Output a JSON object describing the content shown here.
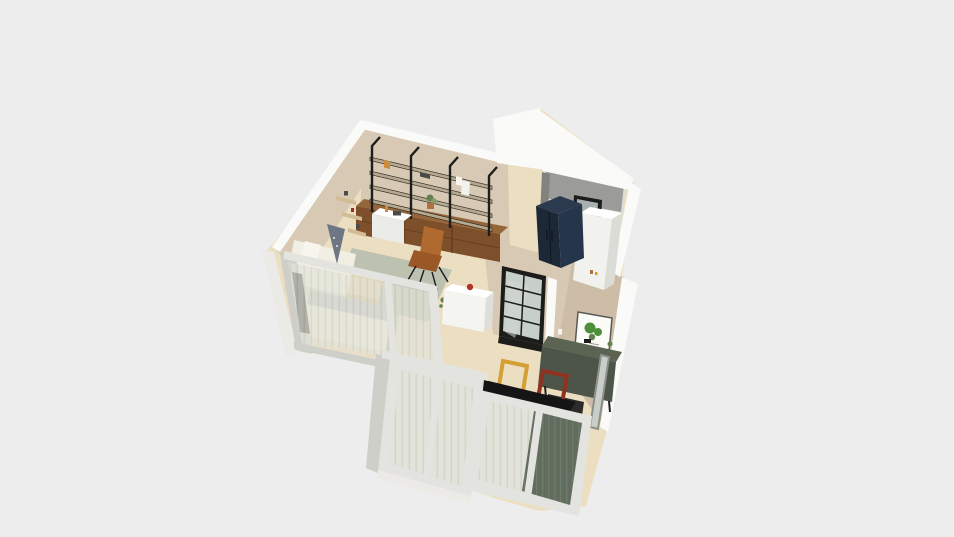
{
  "scene": {
    "type": "3d-floorplan-render",
    "description": "Isometric 3D render of a studio apartment floor plan viewed from above on a plain light grey background",
    "background": "#ededed"
  },
  "palette": {
    "bg": "#ededed",
    "wallWhite": "#fafaf8",
    "wallWhiteShade": "#ebeae6",
    "wallBeige": "#d8c9b4",
    "wallBeigeDark": "#cdbda6",
    "floorCream": "#ecdfc1",
    "floorPale": "#e9dfc9",
    "bathWallGrey": "#9b9b99",
    "bathWallGreyDark": "#82827f",
    "bathFloor": "#dcdcd8",
    "navyCabinet": "#1c2836",
    "navyCabinetSide": "#26364a",
    "navyCabinetTop": "#2c3a50",
    "applianceWhite": "#f1f1ee",
    "applianceShade": "#dcdcd7",
    "windowBlack": "#1c1c1a",
    "windowGlassGrey": "#a8b0b0",
    "glassTint": "#c6cfc8",
    "doorFrameWhite": "#e3e3df",
    "doorFrameShade": "#cfcfca",
    "curtainSheer": "#edebe0",
    "curtainSheerLine": "#d6d2c2",
    "curtainGreen": "#5d685b",
    "curtainGreenLight": "#76816f",
    "shelfBlack": "#1e1e1c",
    "shelfBoardTan": "#b5a88d",
    "cabinetBrown": "#7d4f2a",
    "cabinetBrownTop": "#96663a",
    "cabinetBrownLine": "#5e3a1d",
    "floatShelfTan": "#d2bc96",
    "chairCognac": "#b0692e",
    "chairCognacDark": "#9a5826",
    "rugSage": "#b8beae",
    "bedWhite": "#f1eee3",
    "bedShade": "#ddd7c6",
    "pillowWhite": "#f7f5ed",
    "pillowGrey": "#b9bcbf",
    "tentBlue": "#6e7684",
    "benchTan": "#e4d4ad",
    "benchTanDark": "#d3c094",
    "counterWhite": "#f4f4f1",
    "counterShade": "#dededa",
    "counterTop": "#ffffff",
    "kettleRed": "#b23425",
    "sideboardGreen": "#4c5547",
    "sideboardGreenTop": "#5b6452",
    "artPaper": "#fbfbf8",
    "artLeaf": "#4f8f3c",
    "artFrame": "#5a5a55",
    "frameYellow": "#d4a033",
    "frameRed": "#8f3320",
    "tableBlack": "#151515",
    "tableEdge": "#000000",
    "mirrorFrame": "#8e8e8a",
    "mirrorGlass": "#c8cec8",
    "plantGreen": "#879c6a",
    "plantDark": "#64804e",
    "plantPot": "#eeeee9",
    "terracotta": "#b07040",
    "stoveBlack": "#2b2b29",
    "trunkBrown": "#7a6a4f",
    "redDecor": "#a03022",
    "tanDecor": "#c9a86a",
    "deskWhite": "#ebebe8",
    "darkItem": "#4a4a46",
    "orangeBook": "#cd8a3a",
    "windowSliver": "#3b3b38",
    "reflection": "#d3d7d3"
  },
  "objects": {
    "living_room": [
      "wall shelving unit with wood cabinets",
      "floating wall shelves",
      "day bed with patterned cushion",
      "cognac lounge chair",
      "small desk",
      "sage rug",
      "plant on cabinet"
    ],
    "bedroom": [
      "glass partition with sheer curtains",
      "double bed",
      "tan bench",
      "rug"
    ],
    "kitchen": [
      "white counter with red kettle",
      "black framed glass door",
      "wall trim"
    ],
    "dining": [
      "green sideboard",
      "botanical art print",
      "dark dining table",
      "leaning yellow frame",
      "leaning red frame",
      "floor mirror",
      "tall potted plant"
    ],
    "utility_room": [
      "dark double-door cabinet",
      "white appliance cabinet",
      "black framed window"
    ],
    "south_facade": [
      "sliding glass doors",
      "sheer curtains",
      "dark green curtain"
    ]
  }
}
